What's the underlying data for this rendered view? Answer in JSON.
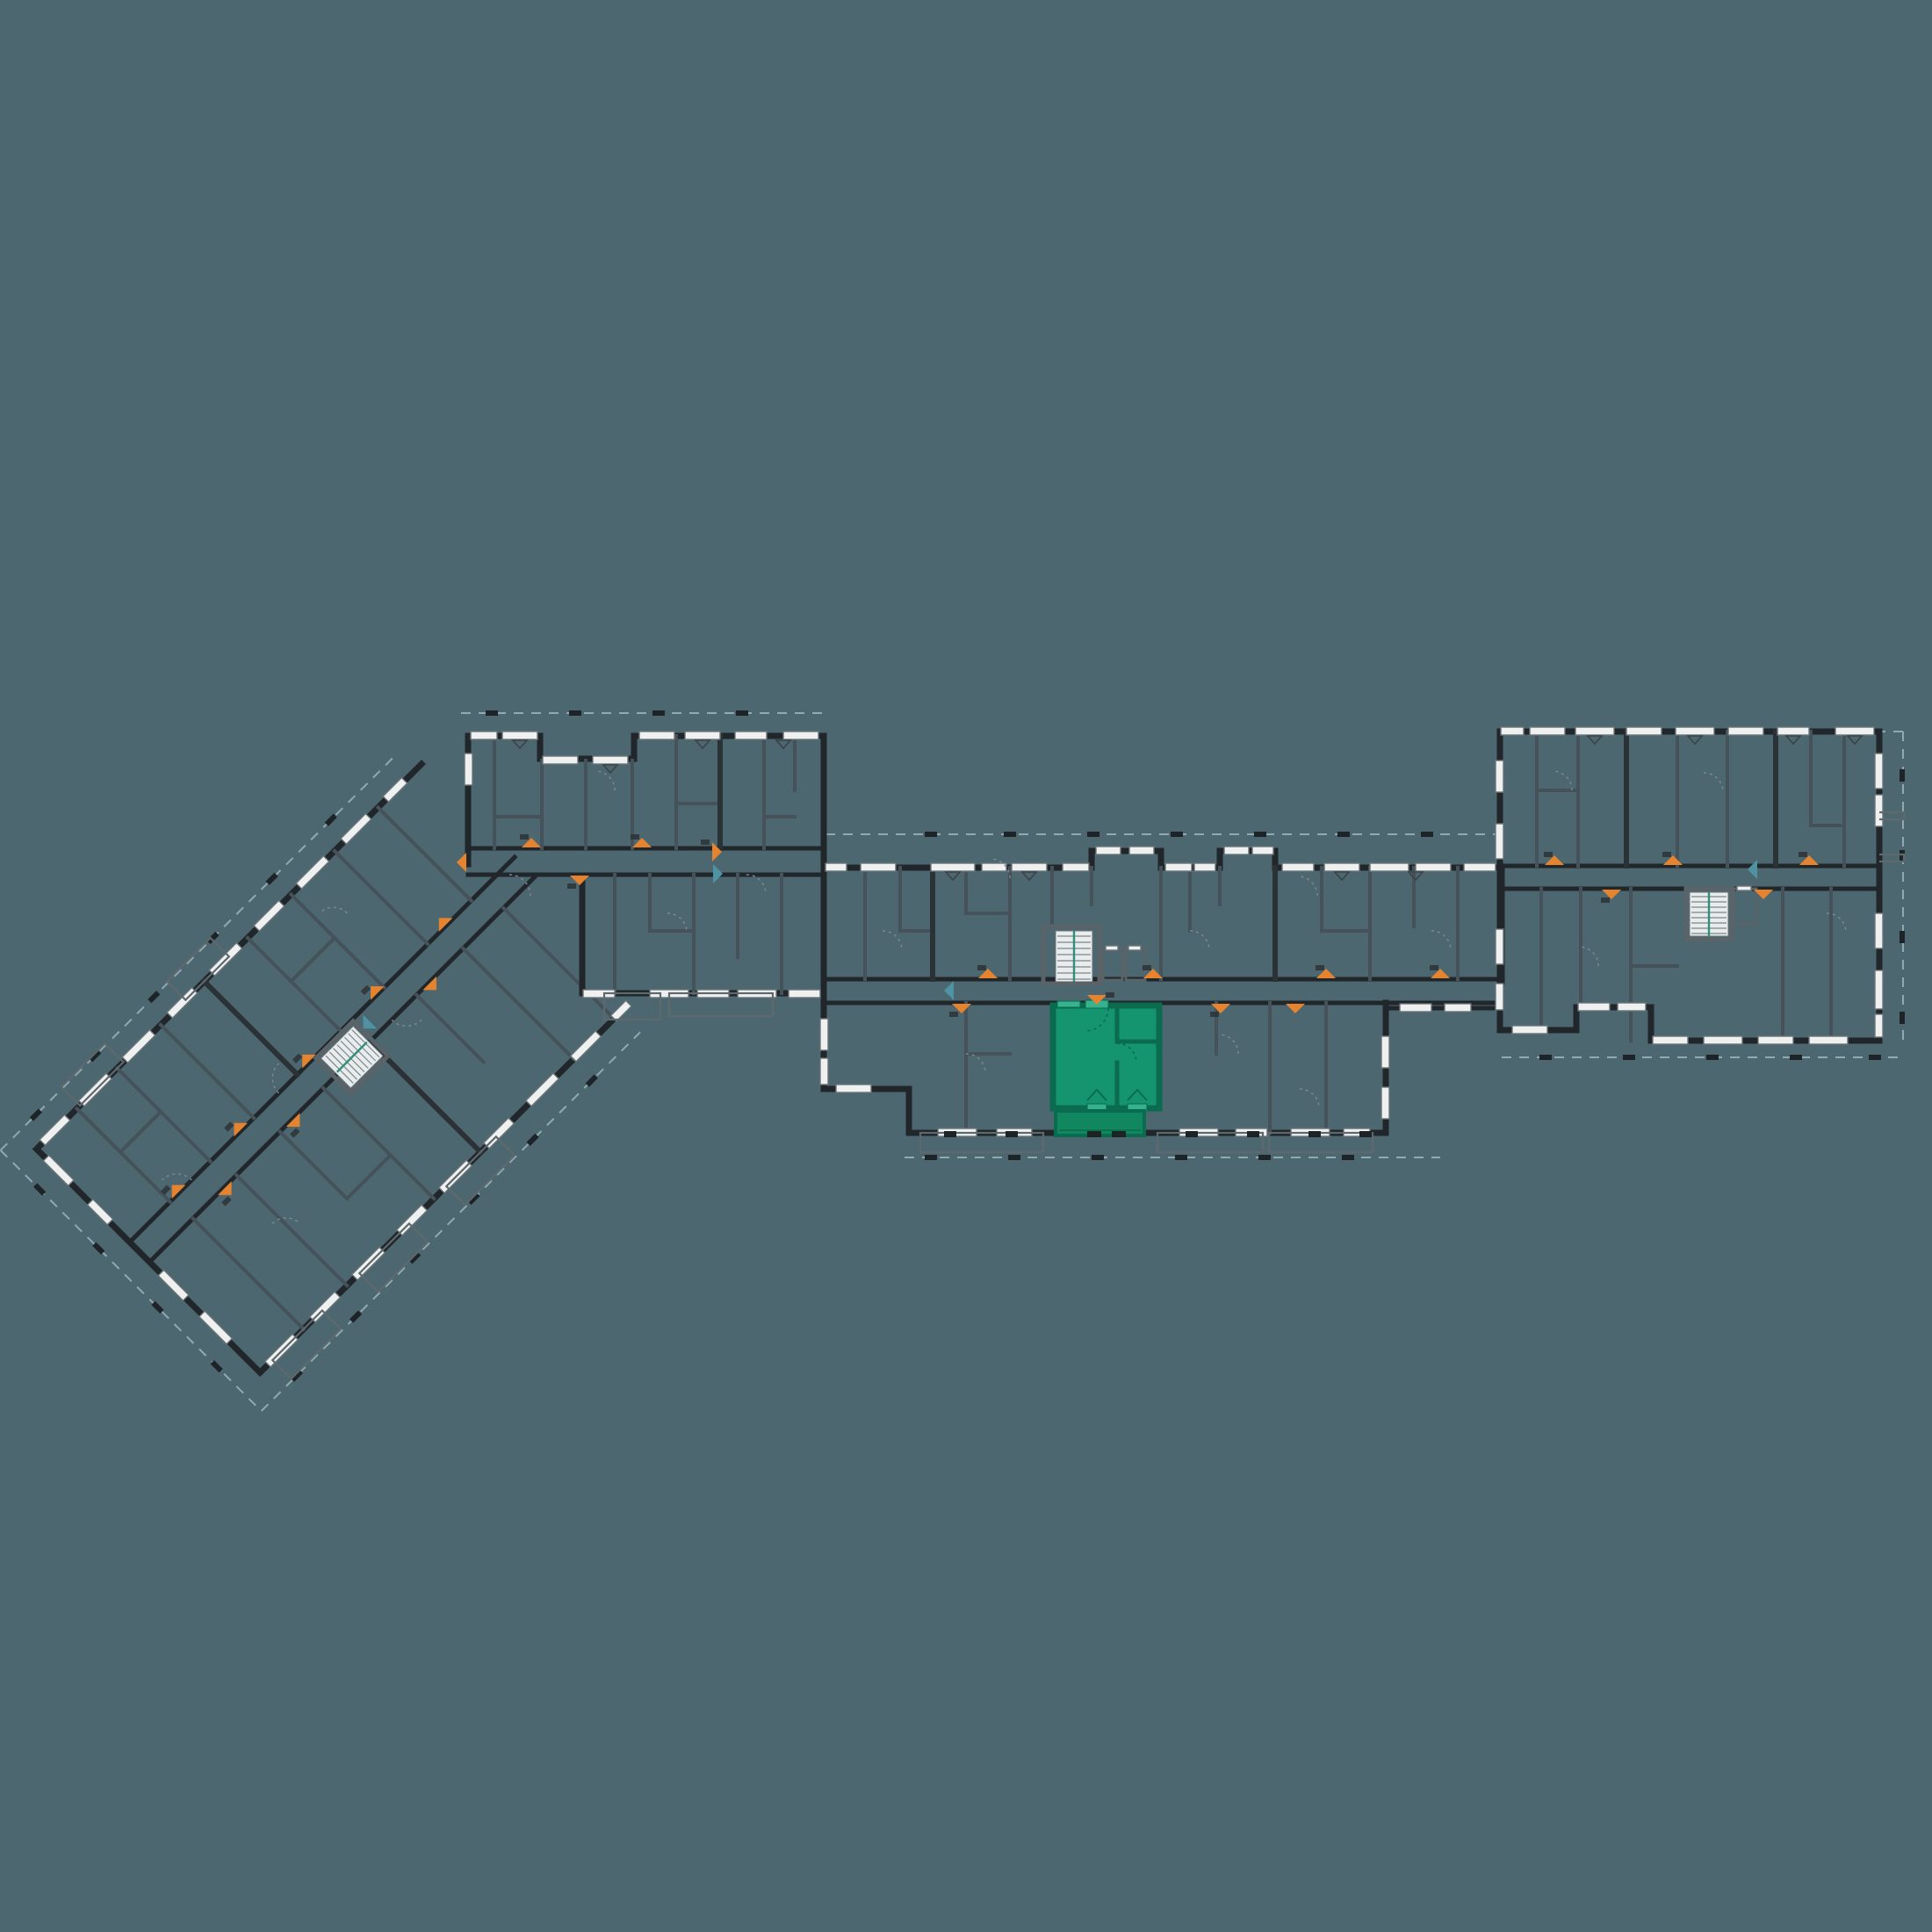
{
  "scene": {
    "title": "Residential complex floor plan",
    "description": "Schematic floor plan of a multi-wing apartment building on a dark teal canvas with one apartment highlighted in green",
    "background_color": "#4c6770",
    "visible_text": "none (all unit-number stamps are illegible at this scale)"
  },
  "palette": {
    "exterior_wall": "#20262a",
    "partition_wall": "#46525a",
    "window_fill": "#eef1f0",
    "window_frame": "#6b7478",
    "plot_boundary_dash": "#9cb6c0",
    "terrace_outline": "#5e696d",
    "door_swing_arc": "#808a8e",
    "entry_marker_orange": "#e5832f",
    "entry_marker_teal": "#4f93a2",
    "stair_tread_fill": "#e8ecec",
    "stair_rail_accent": "#2e8f7a"
  },
  "highlighted_unit": {
    "name": "selected apartment",
    "state": "highlighted / selected",
    "fill": "#15956f",
    "wall_color": "#0a6b4e",
    "window_tint": "#37b28e",
    "balcony_fill": "#10875f",
    "location": "south row of the central wing, immediately east of the main stair-and-elevator core",
    "features": [
      "entry from central corridor",
      "interior partition with door",
      "south-facing balcony with two balcony doors"
    ]
  },
  "buildings": [
    {
      "id": "wing-a",
      "label": "south-west wing",
      "note": "long bar rotated 45 degrees with central corridor and stair"
    },
    {
      "id": "wing-b",
      "label": "west block",
      "note": "double-loaded corridor block linking wing A to the central wing"
    },
    {
      "id": "wing-c",
      "label": "central wing",
      "note": "contains main stair core, two elevator shafts and the highlighted unit"
    },
    {
      "id": "wing-d",
      "label": "north-east block",
      "note": "offset higher than the central wing, own stair and elevator"
    }
  ],
  "markers": {
    "orange_entry_arrows": 26,
    "teal_arrows": 4,
    "stair_cores": 3,
    "elevator_shafts": 3,
    "door_swing_arcs": "dotted quarter circles at interior doors",
    "plot_ticks": "small dark column ticks along dashed plot boundaries"
  }
}
